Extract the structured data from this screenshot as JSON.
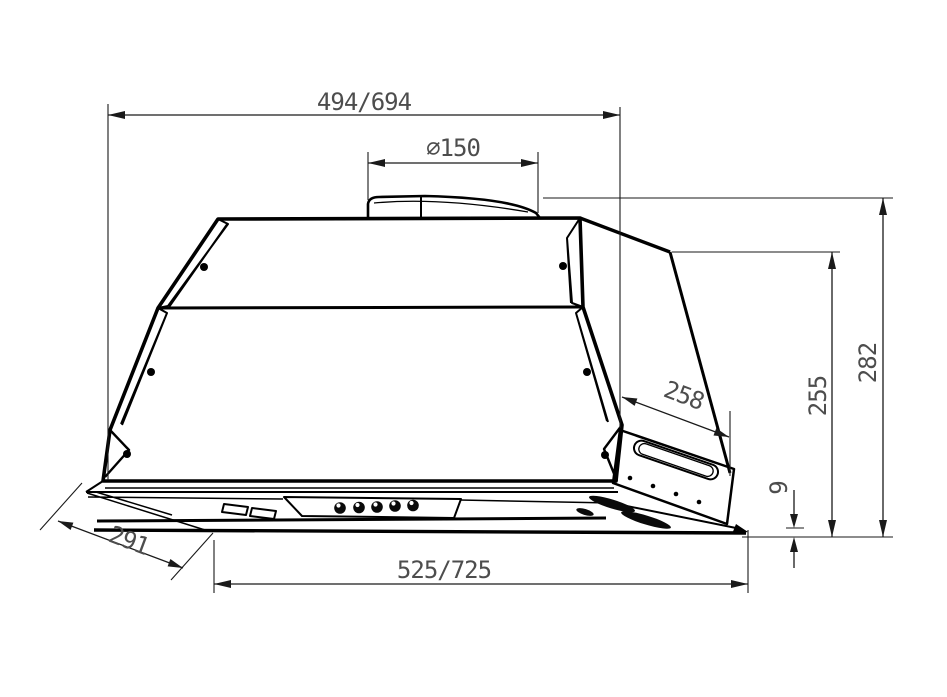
{
  "drawing": {
    "labels": {
      "top_width": "494/694",
      "duct_diameter": "⌀150",
      "overall_height": "282",
      "body_height": "255",
      "side_slant_depth": "258",
      "visor_thickness": "9",
      "visor_depth": "291",
      "bottom_width": "525/725"
    },
    "colors": {
      "line": "#000000",
      "dimension_text": "#4d4d4d",
      "background": "#ffffff"
    }
  }
}
